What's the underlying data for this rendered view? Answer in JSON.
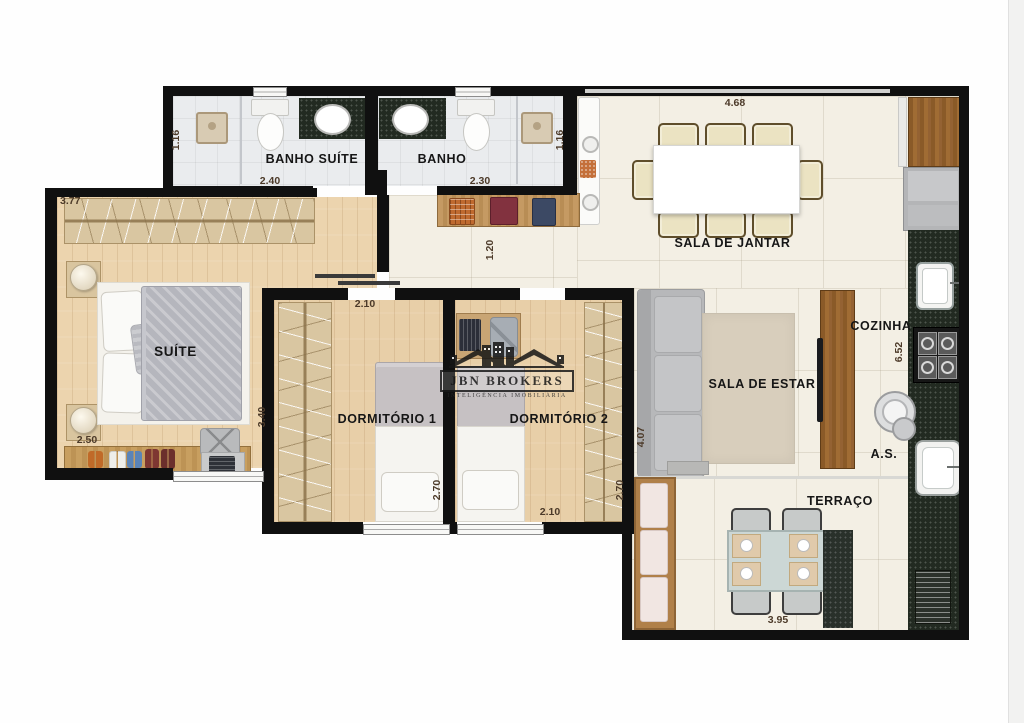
{
  "plan": {
    "labels": {
      "banho_suite": "BANHO SUÍTE",
      "banho": "BANHO",
      "sala_jantar": "SALA DE JANTAR",
      "suite": "SUÍTE",
      "dorm1": "DORMITÓRIO 1",
      "dorm2": "DORMITÓRIO 2",
      "sala_estar": "SALA DE ESTAR",
      "cozinha": "COZINHA",
      "area_servico": "A.S.",
      "terraco": "TERRAÇO"
    },
    "dims": {
      "suite_top": "3.77",
      "suite_bottom": "2.50",
      "suite_depth": "3.40",
      "banho_suite_w": "2.40",
      "banho_suite_d": "1.16",
      "banho_w": "2.30",
      "banho_d": "1.16",
      "jantar_w": "4.68",
      "hall_w": "1.20",
      "dorm1_w": "2.10",
      "dorm1_d": "2.70",
      "dorm2_w": "2.10",
      "dorm2_d": "2.70",
      "estar_d": "4.07",
      "cozinha_d": "6.52",
      "terraco_w": "3.95"
    }
  },
  "brand": {
    "name": "JBN BROKERS",
    "tagline": "INTELIGÊNCIA IMOBILIÁRIA"
  },
  "colors": {
    "wall": "#101010",
    "wood_floor": "#e8cfa8",
    "tile_floor": "#f3efe4",
    "bath_floor": "#eaecee",
    "granite": "#222a21",
    "cabinet_wood": "#9c6a31",
    "dimension_text": "#4c3a29"
  }
}
